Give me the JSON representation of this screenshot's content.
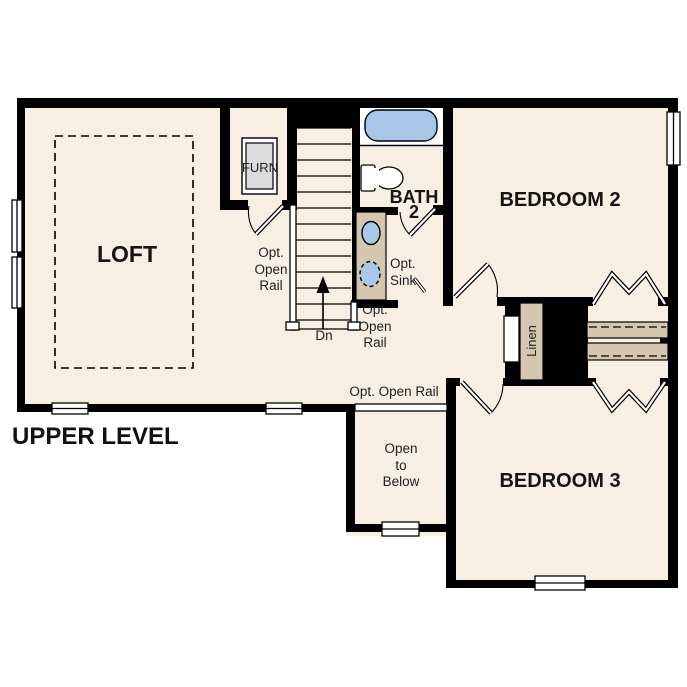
{
  "plan": {
    "title": "UPPER LEVEL",
    "rooms": {
      "loft": {
        "label": "LOFT"
      },
      "bedroom2": {
        "label": "BEDROOM 2"
      },
      "bedroom3": {
        "label": "BEDROOM 3"
      },
      "bath2": {
        "line1": "BATH",
        "line2": "2"
      },
      "furnace_closet": {
        "label": "FURN"
      },
      "linen_closet": {
        "label": "Linen"
      },
      "open_to_below": {
        "line1": "Open",
        "line2": "to",
        "line3": "Below"
      }
    },
    "annotations": {
      "opt_open_rail_left": {
        "line1": "Opt.",
        "line2": "Open",
        "line3": "Rail"
      },
      "opt_open_rail_right": {
        "line1": "Opt.",
        "line2": "Open",
        "line3": "Rail"
      },
      "opt_open_rail_hall": {
        "label": "Opt. Open Rail"
      },
      "opt_sink": {
        "line1": "Opt.",
        "line2": "Sink"
      },
      "stair_direction": {
        "label": "Dn"
      }
    },
    "colors": {
      "floor": "#f6efe2",
      "walls": "#000000",
      "casework_tan": "#d5c7af",
      "plumbing_fixture_blue": "#a8c6e8",
      "furnace_gray": "#dcdcdc",
      "label_text": "#1f1f1f"
    }
  }
}
